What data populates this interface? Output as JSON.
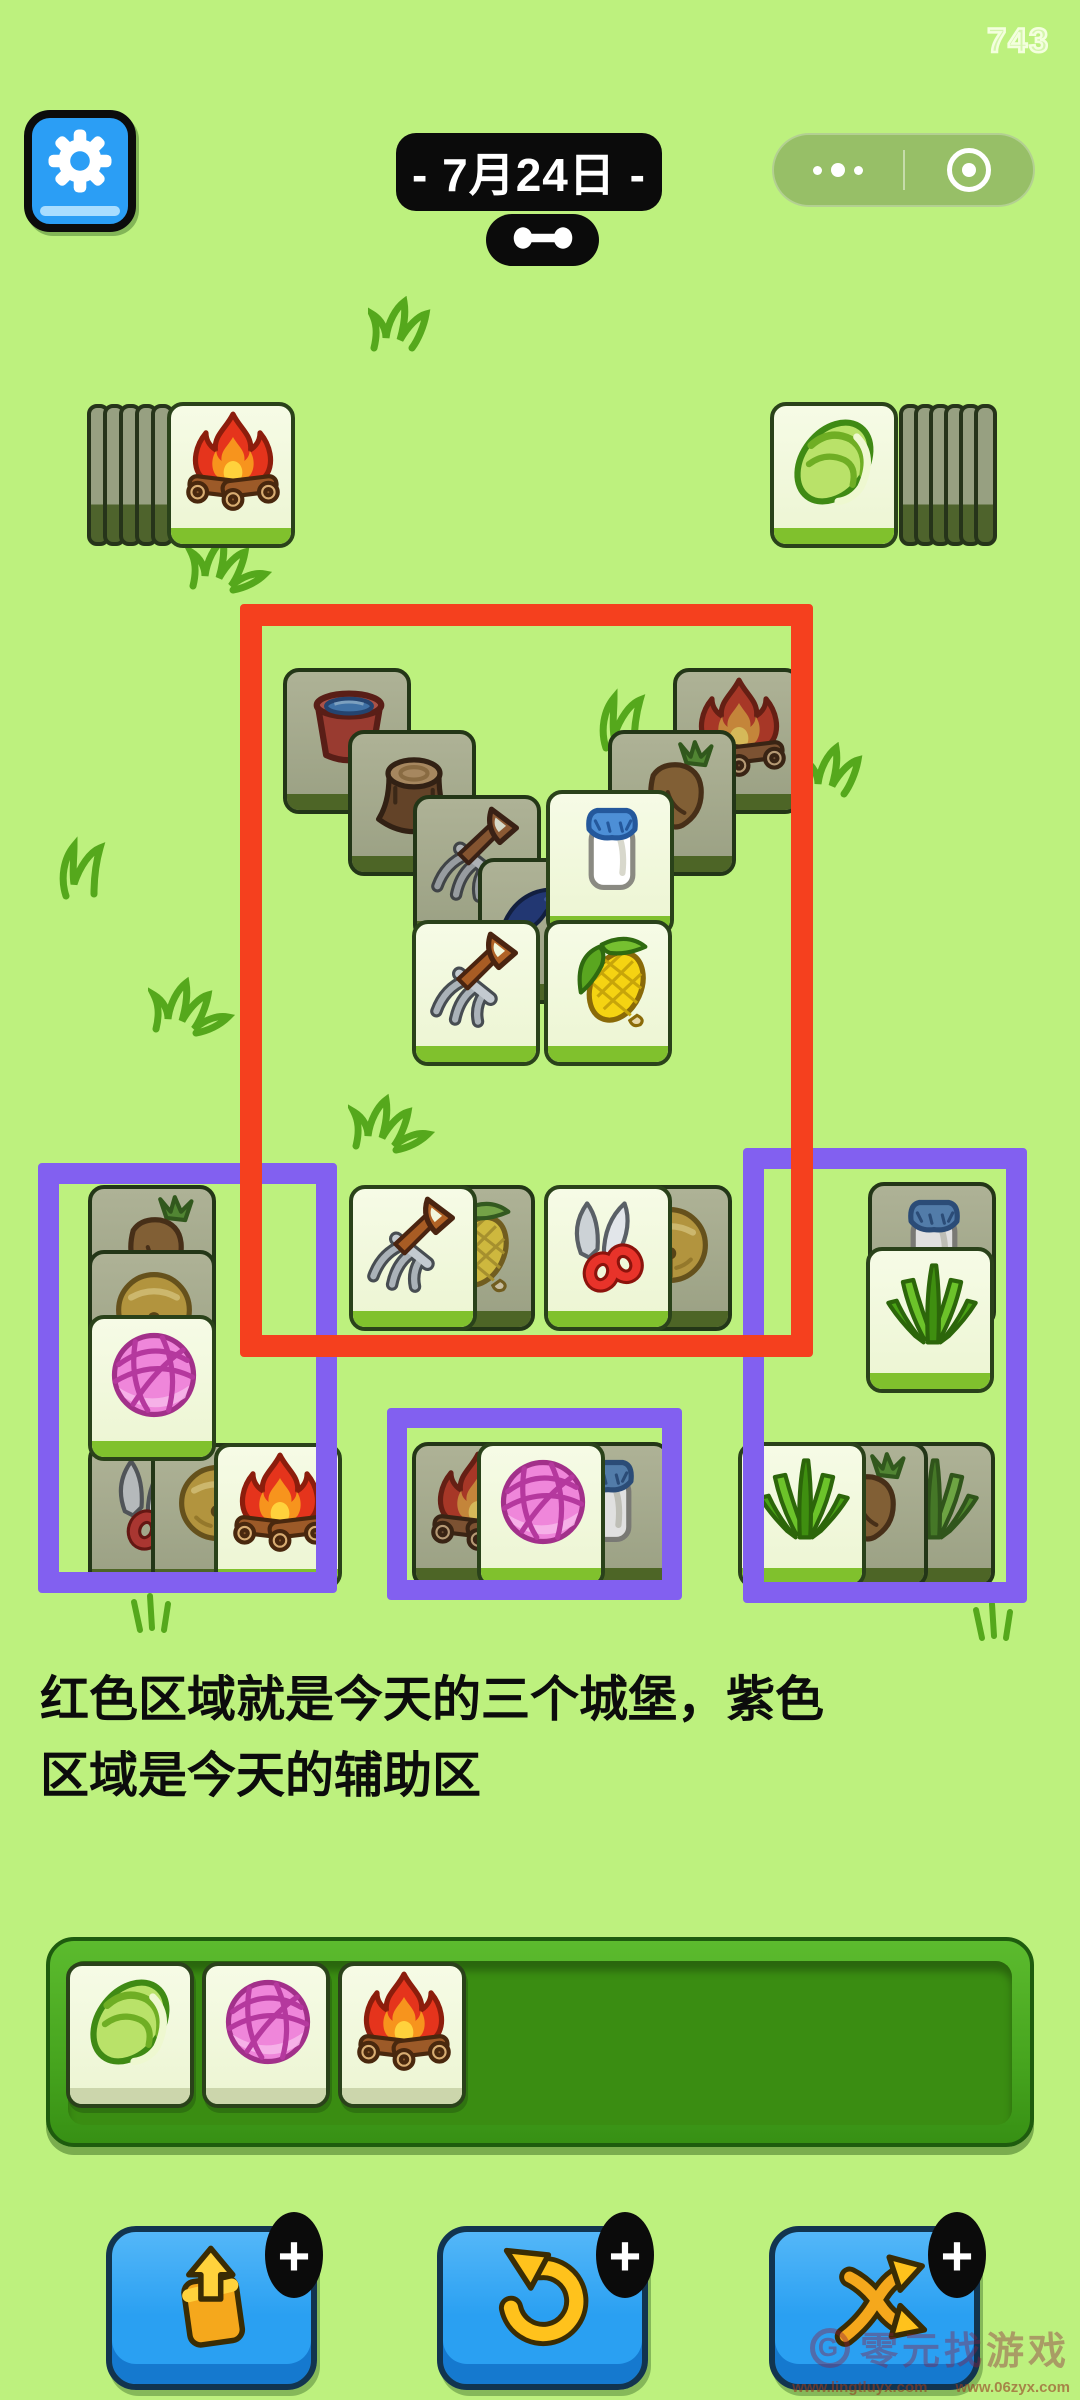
{
  "hud": {
    "score": "743",
    "date_label": "- 7月24日 -",
    "settings_icon": "gear-icon",
    "capsule": {
      "more_icon": "more-dots-icon",
      "home_icon": "target-icon"
    }
  },
  "annotation": {
    "line1": "红色区域就是今天的三个城堡，紫色",
    "line2": "区域是今天的辅助区",
    "colors": {
      "red": "#f5401e",
      "purple": "#8260f0"
    }
  },
  "board": {
    "stacks": [
      {
        "id": "left-stack",
        "icon": "campfire",
        "x": 167,
        "y": 402,
        "edge_count": 5,
        "side": "left"
      },
      {
        "id": "right-stack",
        "icon": "cabbage",
        "x": 770,
        "y": 402,
        "edge_count": 6,
        "side": "right"
      }
    ],
    "zones": [
      {
        "id": "castle-zone",
        "color_key": "red",
        "x": 240,
        "y": 604,
        "w": 573,
        "h": 753,
        "border": 22,
        "z": 60
      },
      {
        "id": "helper-zone-left",
        "color_key": "purple",
        "x": 38,
        "y": 1163,
        "w": 299,
        "h": 430,
        "border": 21,
        "z": 55
      },
      {
        "id": "helper-zone-middle",
        "color_key": "purple",
        "x": 387,
        "y": 1408,
        "w": 295,
        "h": 192,
        "border": 20,
        "z": 55
      },
      {
        "id": "helper-zone-right",
        "color_key": "purple",
        "x": 743,
        "y": 1148,
        "w": 284,
        "h": 455,
        "border": 21,
        "z": 55
      }
    ],
    "tiles": [
      {
        "icon": "bucket",
        "x": 283,
        "y": 668,
        "covered": true,
        "z": 10
      },
      {
        "icon": "campfire",
        "x": 673,
        "y": 668,
        "covered": true,
        "z": 10
      },
      {
        "icon": "stump",
        "x": 348,
        "y": 730,
        "covered": true,
        "z": 11
      },
      {
        "icon": "carrot",
        "x": 608,
        "y": 730,
        "covered": true,
        "z": 11
      },
      {
        "icon": "pitchfork",
        "x": 413,
        "y": 795,
        "covered": true,
        "z": 12
      },
      {
        "icon": "blue-object",
        "x": 478,
        "y": 858,
        "covered": true,
        "z": 13
      },
      {
        "icon": "milk",
        "x": 546,
        "y": 790,
        "covered": false,
        "z": 14
      },
      {
        "icon": "pitchfork",
        "x": 412,
        "y": 920,
        "covered": false,
        "z": 15
      },
      {
        "icon": "corn",
        "x": 544,
        "y": 920,
        "covered": false,
        "z": 15
      },
      {
        "icon": "corn",
        "x": 407,
        "y": 1185,
        "covered": true,
        "z": 10
      },
      {
        "icon": "pitchfork",
        "x": 349,
        "y": 1185,
        "covered": false,
        "z": 11
      },
      {
        "icon": "bell",
        "x": 604,
        "y": 1185,
        "covered": true,
        "z": 10
      },
      {
        "icon": "shears",
        "x": 544,
        "y": 1185,
        "covered": false,
        "z": 11
      },
      {
        "icon": "carrot",
        "x": 88,
        "y": 1185,
        "covered": true,
        "z": 10
      },
      {
        "icon": "bell",
        "x": 88,
        "y": 1250,
        "covered": true,
        "z": 11
      },
      {
        "icon": "yarn",
        "x": 88,
        "y": 1315,
        "covered": false,
        "z": 12
      },
      {
        "icon": "shears",
        "x": 88,
        "y": 1443,
        "covered": true,
        "z": 10
      },
      {
        "icon": "bell",
        "x": 151,
        "y": 1443,
        "covered": true,
        "z": 11
      },
      {
        "icon": "campfire",
        "x": 214,
        "y": 1443,
        "covered": false,
        "z": 12
      },
      {
        "icon": "campfire",
        "x": 412,
        "y": 1442,
        "covered": true,
        "z": 10
      },
      {
        "icon": "milk",
        "x": 542,
        "y": 1442,
        "covered": true,
        "z": 10
      },
      {
        "icon": "yarn",
        "x": 477,
        "y": 1442,
        "covered": false,
        "z": 11
      },
      {
        "icon": "milk",
        "x": 868,
        "y": 1182,
        "covered": true,
        "z": 10
      },
      {
        "icon": "grass",
        "x": 866,
        "y": 1247,
        "covered": false,
        "z": 11
      },
      {
        "icon": "grass",
        "x": 867,
        "y": 1442,
        "covered": true,
        "z": 10
      },
      {
        "icon": "carrot",
        "x": 800,
        "y": 1442,
        "covered": true,
        "z": 11
      },
      {
        "icon": "grass",
        "x": 738,
        "y": 1442,
        "covered": false,
        "z": 12
      }
    ],
    "decorations": [
      {
        "variant": "squiggle",
        "x": 368,
        "y": 296
      },
      {
        "variant": "tuft",
        "x": 185,
        "y": 532
      },
      {
        "variant": "curl",
        "x": 596,
        "y": 688
      },
      {
        "variant": "squiggle",
        "x": 800,
        "y": 742
      },
      {
        "variant": "curl",
        "x": 56,
        "y": 836
      },
      {
        "variant": "tuft",
        "x": 148,
        "y": 975
      },
      {
        "variant": "tuft",
        "x": 348,
        "y": 1092
      },
      {
        "variant": "sprout",
        "x": 130,
        "y": 1590
      },
      {
        "variant": "sprout",
        "x": 972,
        "y": 1598
      }
    ]
  },
  "tray": {
    "slots": [
      "cabbage",
      "yarn",
      "campfire"
    ]
  },
  "toolbar": {
    "badge": "+",
    "buttons": [
      {
        "id": "extract-button",
        "icon": "popout-icon",
        "x": 106
      },
      {
        "id": "undo-button",
        "icon": "undo-icon",
        "x": 437
      },
      {
        "id": "shuffle-button",
        "icon": "shuffle-icon",
        "x": 769
      }
    ]
  },
  "watermark": {
    "brand": "零元找游戏",
    "g_mark": "G",
    "url1": "www.lingtluyx.com",
    "url2": "www.06zyx.com"
  }
}
